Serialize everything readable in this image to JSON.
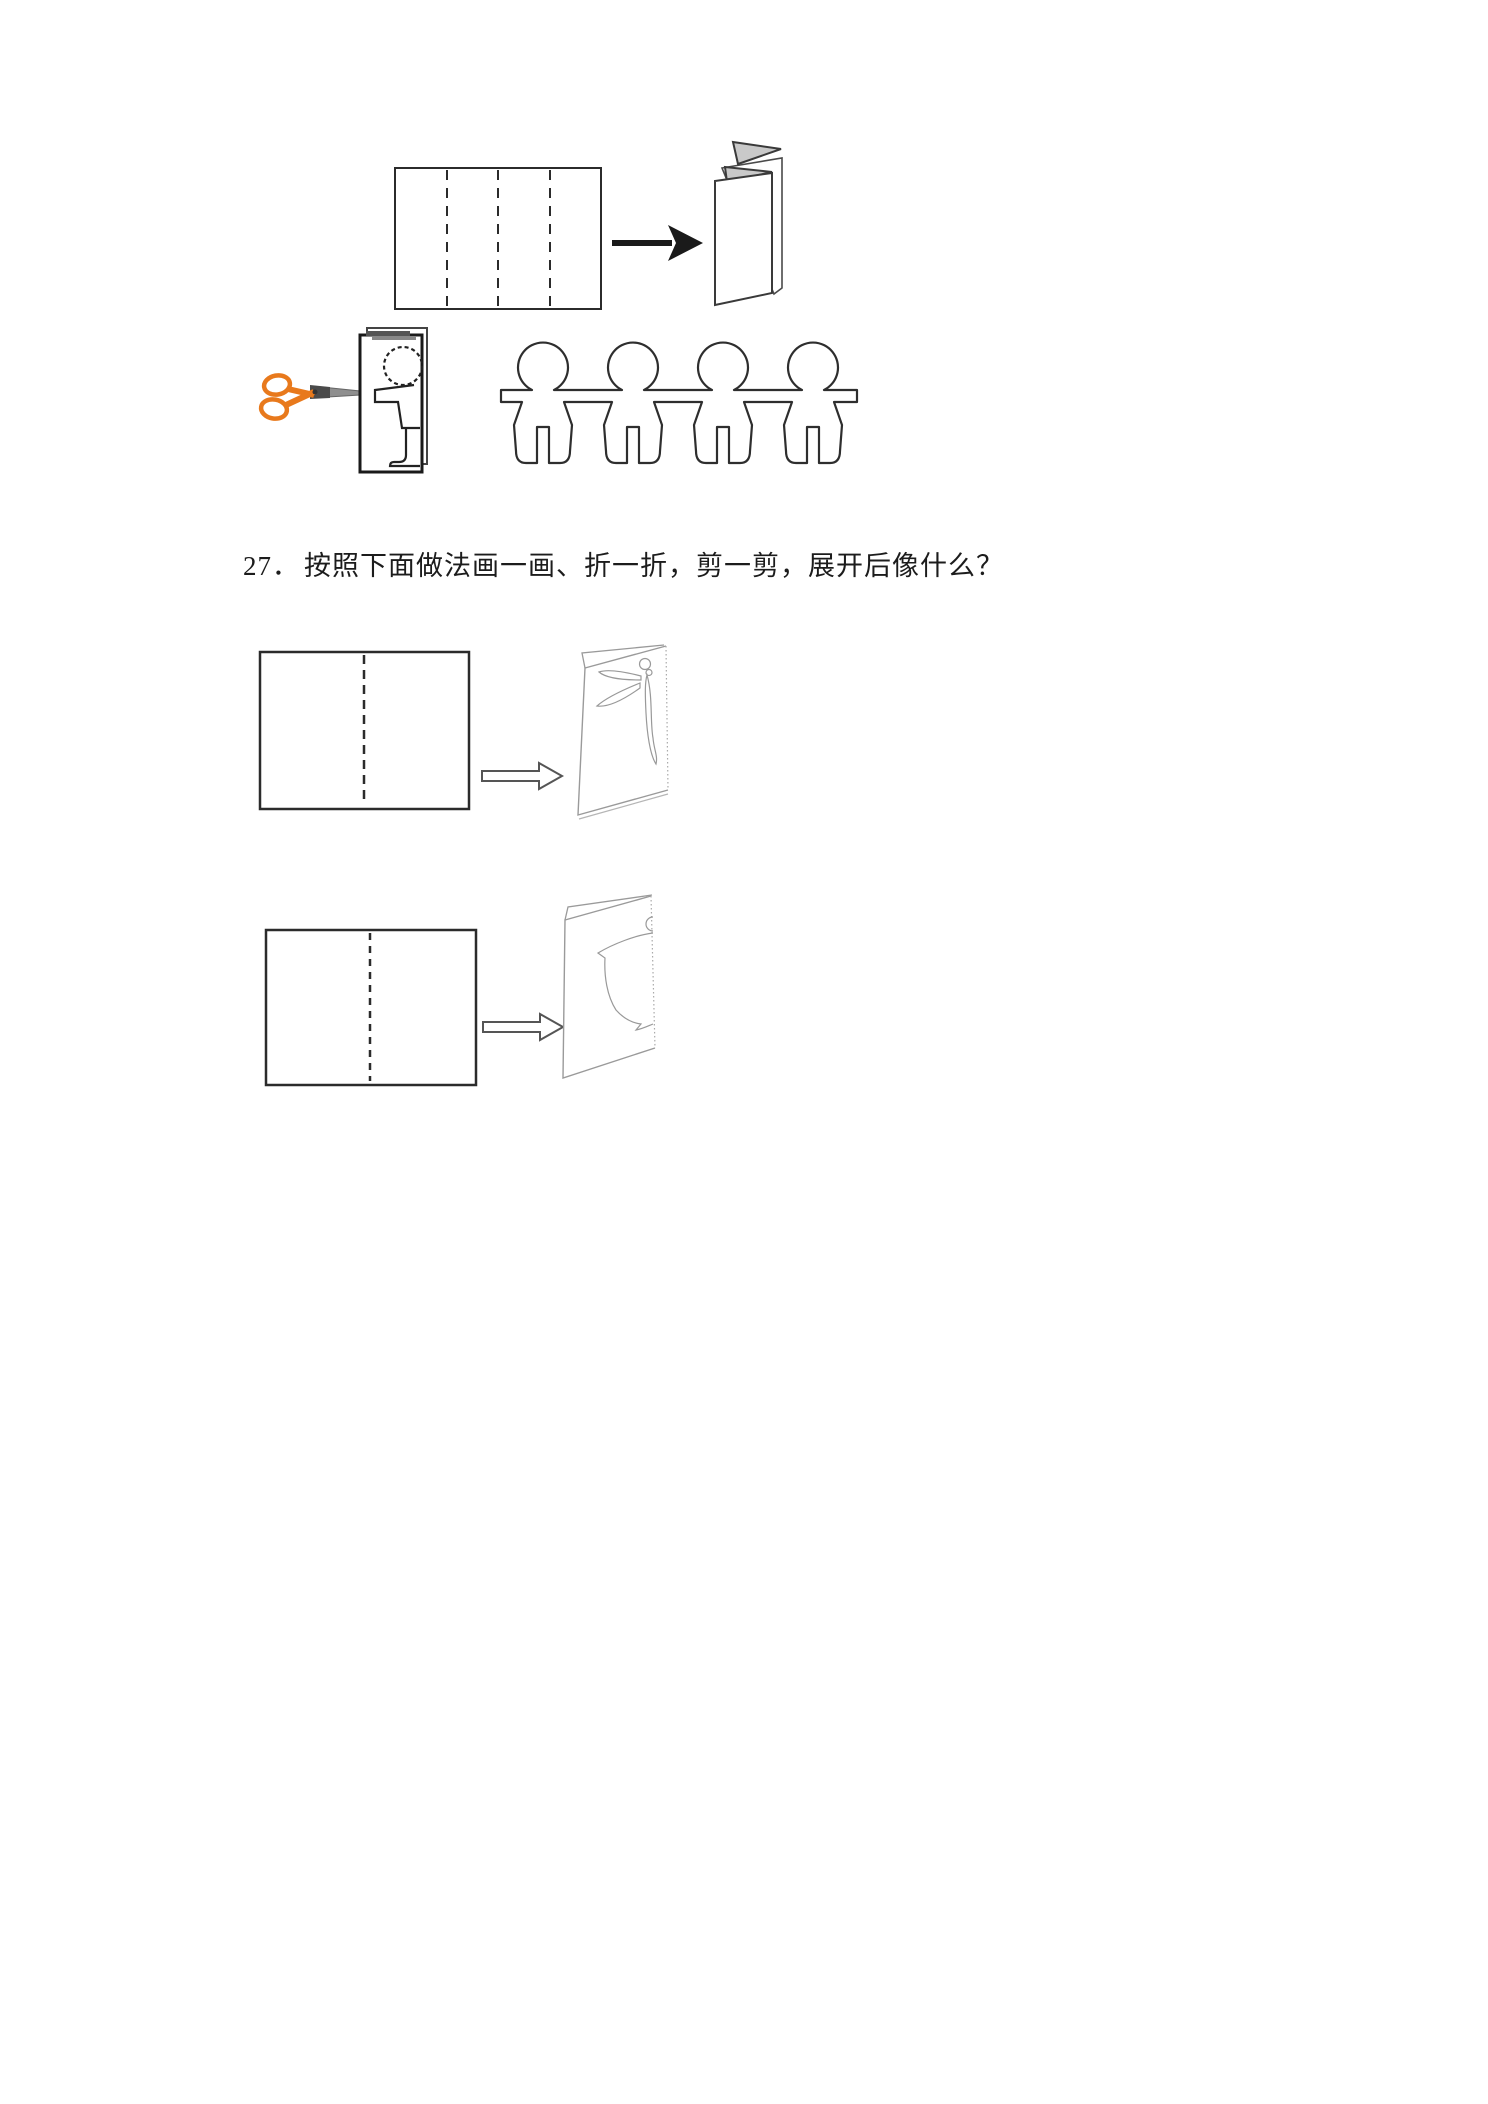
{
  "question": {
    "number": "27．",
    "text": "按照下面做法画一画、折一折，剪一剪，展开后像什么？"
  },
  "figures": {
    "step_fold_sheet": "paper-with-three-dashed-fold-lines",
    "step_folded": "accordion-folded-paper",
    "step_cut": "scissors-cutting-folded-paper-with-half-person-outline",
    "step_result": "paper-doll-chain-of-four",
    "q27_sheet1": "paper-with-center-dashed-fold-line",
    "q27_folded1": "folded-paper-with-half-dragonfly-sketch",
    "q27_sheet2": "paper-with-center-dashed-fold-line",
    "q27_folded2": "folded-paper-with-half-vase-sketch"
  },
  "colors": {
    "paper_bg": "#ffffff",
    "ink": "#2b2b2b",
    "sketch": "#999999",
    "scissors_orange": "#e8791c",
    "blade_gray": "#8f8f8f",
    "blade_dark": "#4a4a4a",
    "fold_shade": "#c9c9c9",
    "fold_edge_dark": "#3a3a3a"
  }
}
